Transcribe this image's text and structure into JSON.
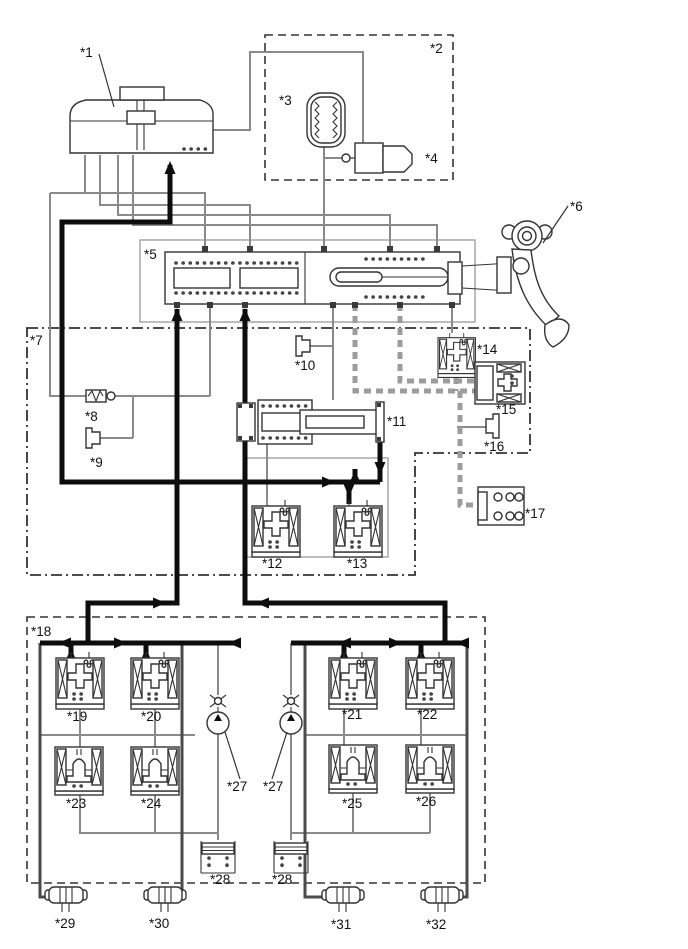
{
  "figure": {
    "canvas": {
      "width": 688,
      "height": 949
    },
    "colors": {
      "background": "#ffffff",
      "outline": "#333333",
      "pipe_gray": "#8a8a8a",
      "flow_black": "#0d0d0d",
      "striped_gray": "#9c9c9c"
    },
    "labels": [
      {
        "id": "1",
        "text": "*1",
        "x": 80,
        "y": 57
      },
      {
        "id": "2",
        "text": "*2",
        "x": 430,
        "y": 53
      },
      {
        "id": "3",
        "text": "*3",
        "x": 279,
        "y": 105
      },
      {
        "id": "4",
        "text": "*4",
        "x": 425,
        "y": 163
      },
      {
        "id": "5",
        "text": "*5",
        "x": 144,
        "y": 259
      },
      {
        "id": "6",
        "text": "*6",
        "x": 570,
        "y": 211
      },
      {
        "id": "7",
        "text": "*7",
        "x": 30,
        "y": 345
      },
      {
        "id": "8",
        "text": "*8",
        "x": 85,
        "y": 421
      },
      {
        "id": "9",
        "text": "*9",
        "x": 90,
        "y": 467
      },
      {
        "id": "10",
        "text": "*10",
        "x": 295,
        "y": 370
      },
      {
        "id": "11",
        "text": "*11",
        "x": 387,
        "y": 426
      },
      {
        "id": "12",
        "text": "*12",
        "x": 262,
        "y": 568
      },
      {
        "id": "13",
        "text": "*13",
        "x": 347,
        "y": 568
      },
      {
        "id": "14",
        "text": "*14",
        "x": 477,
        "y": 354
      },
      {
        "id": "15",
        "text": "*15",
        "x": 496,
        "y": 414
      },
      {
        "id": "16",
        "text": "*16",
        "x": 484,
        "y": 451
      },
      {
        "id": "17",
        "text": "*17",
        "x": 525,
        "y": 518
      },
      {
        "id": "18",
        "text": "*18",
        "x": 31,
        "y": 636
      },
      {
        "id": "19",
        "text": "*19",
        "x": 67,
        "y": 721
      },
      {
        "id": "20",
        "text": "*20",
        "x": 141,
        "y": 721
      },
      {
        "id": "21",
        "text": "*21",
        "x": 342,
        "y": 719
      },
      {
        "id": "22",
        "text": "*22",
        "x": 417,
        "y": 719
      },
      {
        "id": "23",
        "text": "*23",
        "x": 66,
        "y": 808
      },
      {
        "id": "24",
        "text": "*24",
        "x": 141,
        "y": 808
      },
      {
        "id": "25",
        "text": "*25",
        "x": 342,
        "y": 808
      },
      {
        "id": "26",
        "text": "*26",
        "x": 416,
        "y": 806
      },
      {
        "id": "27-left",
        "text": "*27",
        "x": 227,
        "y": 791
      },
      {
        "id": "27-right",
        "text": "*27",
        "x": 263,
        "y": 791
      },
      {
        "id": "28-left",
        "text": "*28",
        "x": 210,
        "y": 884
      },
      {
        "id": "28-right",
        "text": "*28",
        "x": 272,
        "y": 884
      },
      {
        "id": "29",
        "text": "*29",
        "x": 55,
        "y": 928
      },
      {
        "id": "30",
        "text": "*30",
        "x": 149,
        "y": 928
      },
      {
        "id": "31",
        "text": "*31",
        "x": 331,
        "y": 929
      },
      {
        "id": "32",
        "text": "*32",
        "x": 426,
        "y": 929
      }
    ]
  }
}
